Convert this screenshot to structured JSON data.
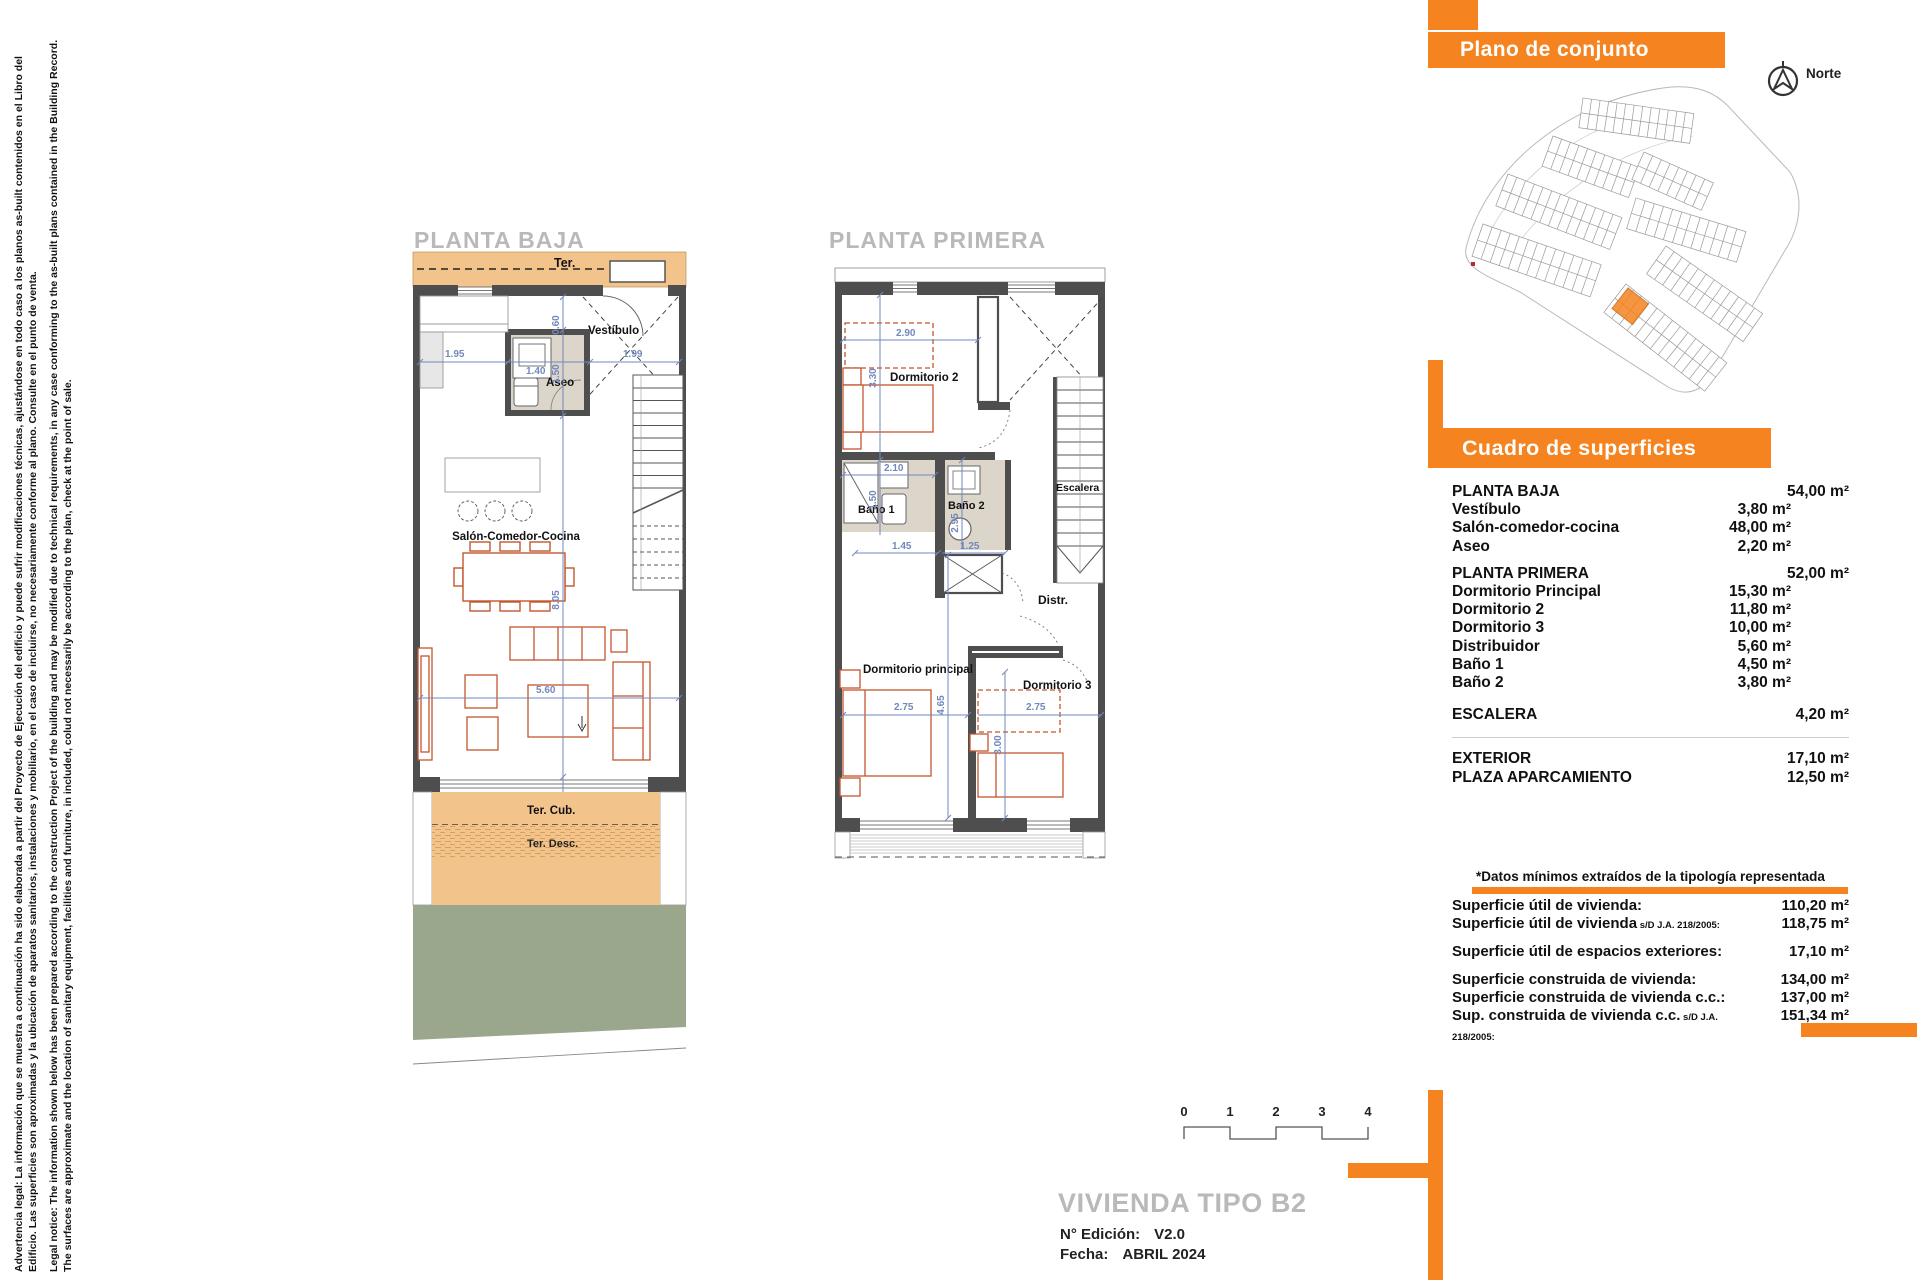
{
  "legal": {
    "es": "Advertencia legal: La información que se muestra a continuación ha sido elaborada a partir del Proyecto de Ejecución del edificio y puede sufrir modificaciones técnicas, ajustándose en todo caso a los planos as-built contenidos en el Libro del Edificio. Las superficies son aproximadas y la ubicación de aparatos sanitarios, instalaciones y mobiliario, en el caso de incluirse, no necesariamente conforme al plano. Consulte en el punto de venta.",
    "en": "Legal notice: The information shown below has been prepared according to the construction Project of the building and may be modified due to technical requirements, in any case conforming to the as-built plans contained in the Building Record. The surfaces are approximate and the location of sanitary equipment, facilities and furniture, in included, colud not necessarily be according to the plan, check at the point of sale."
  },
  "plans": {
    "pb": {
      "title": "PLANTA BAJA",
      "ter": "Ter.",
      "vestibulo": "Vestíbulo",
      "aseo": "Aseo",
      "salon": "Salón-Comedor-Cocina",
      "tercub": "Ter. Cub.",
      "terdesc": "Ter. Desc.",
      "dims": {
        "left": "1.95",
        "aseo": "1.40",
        "right": "1.99",
        "v060": "0.60",
        "v150": "1.50",
        "v805": "8.05",
        "h560": "5.60",
        "h585": "5.85"
      }
    },
    "pp": {
      "title": "PLANTA PRIMERA",
      "dorm2": "Dormitorio 2",
      "bano1": "Baño 1",
      "bano2": "Baño 2",
      "escalera": "Escalera",
      "distr": "Distr.",
      "dormppal": "Dormitorio principal",
      "dorm3": "Dormitorio 3",
      "dims": {
        "d290": "2.90",
        "d330": "3.30",
        "d210": "2.10",
        "d150": "1.50",
        "d295": "2.95",
        "d145": "1.45",
        "d125": "1.25",
        "d275a": "2.75",
        "d465": "4.65",
        "d275b": "2.75",
        "d300": "3.00"
      }
    }
  },
  "site": {
    "header": "Plano de conjunto",
    "north": "Norte"
  },
  "surfaces": {
    "header": "Cuadro de superficies",
    "sections": [
      {
        "label": "PLANTA BAJA",
        "total": "54,00 m²",
        "rows": [
          [
            "Vestíbulo",
            "3,80 m²"
          ],
          [
            "Salón-comedor-cocina",
            "48,00 m²"
          ],
          [
            "Aseo",
            "2,20 m²"
          ]
        ]
      },
      {
        "label": "PLANTA PRIMERA",
        "total": "52,00 m²",
        "gap": "mt1",
        "rows": [
          [
            "Dormitorio Principal",
            "15,30 m²"
          ],
          [
            "Dormitorio 2",
            "11,80 m²"
          ],
          [
            "Dormitorio 3",
            "10,00 m²"
          ],
          [
            "Distribuidor",
            "5,60 m²"
          ],
          [
            "Baño 1",
            "4,50 m²"
          ],
          [
            "Baño 2",
            "3,80 m²"
          ]
        ]
      },
      {
        "label": "ESCALERA",
        "total": "4,20 m²",
        "gap": "mt2",
        "rows": []
      },
      {
        "label": "EXTERIOR",
        "total": "17,10 m²",
        "divider": true,
        "rows": []
      },
      {
        "label": "PLAZA APARCAMIENTO",
        "total": "12,50 m²",
        "rows": []
      }
    ]
  },
  "datos": {
    "note": "*Datos mínimos extraídos de la tipología representada",
    "rows": [
      {
        "label": "Superficie útil de vivienda:",
        "small": "",
        "value": "110,20 m²"
      },
      {
        "label": "Superficie útil de vivienda",
        "small": "s/D J.A. 218/2005:",
        "value": "118,75 m²",
        "gap": "gap8"
      },
      {
        "label": "Superficie útil de espacios exteriores:",
        "small": "",
        "value": "17,10 m²",
        "gap": "gap10"
      },
      {
        "label": "Superficie construida de vivienda:",
        "small": "",
        "value": "134,00 m²"
      },
      {
        "label": "Superficie construida de vivienda c.c.:",
        "small": "",
        "value": "137,00 m²"
      },
      {
        "label": "Sup. construida de vivienda c.c.",
        "small": "s/D J.A. 218/2005:",
        "value": "151,34 m²"
      }
    ]
  },
  "titleblock": {
    "scale": [
      "0",
      "1",
      "2",
      "3",
      "4"
    ],
    "title": "VIVIENDA TIPO B2",
    "ed_label": "N° Edición:",
    "ed_value": "V2.0",
    "date_label": "Fecha:",
    "date_value": "ABRIL 2024"
  },
  "colors": {
    "orange": "#F5831F",
    "tan": "#F2C48C",
    "green": "#9AA78C",
    "dim_blue": "#7288BD",
    "furniture": "#C2552D",
    "wall": "#4E4E4E"
  }
}
